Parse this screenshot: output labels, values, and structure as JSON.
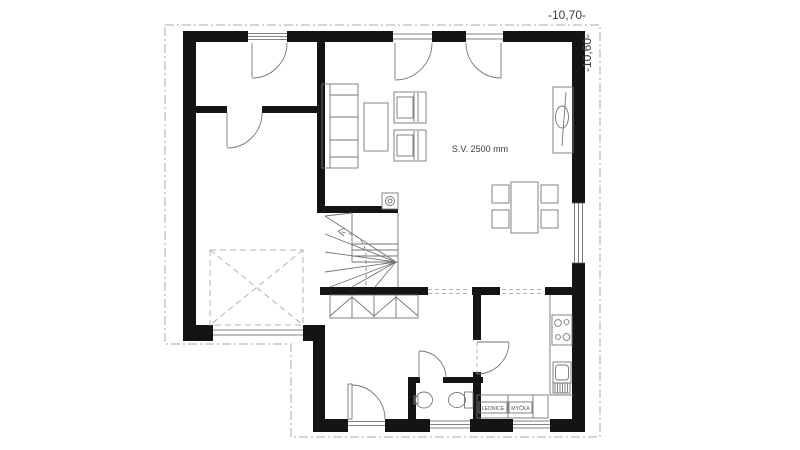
{
  "annotations": {
    "width_dim": "-10,70-",
    "height_dim": "-10,60-",
    "ceiling_height": "S.V. 2500 mm",
    "fridge": "LEDNICE",
    "dishwasher": "MYČKA"
  },
  "colors": {
    "background": "#ffffff",
    "walls": "#141414",
    "furniture_lines": "#767676",
    "window_lines": "#5a5a5a",
    "boundary_line": "#ababab",
    "dashed_marker": "#b3b3b3",
    "text": "#3c3c3c",
    "text_small": "#555555"
  }
}
